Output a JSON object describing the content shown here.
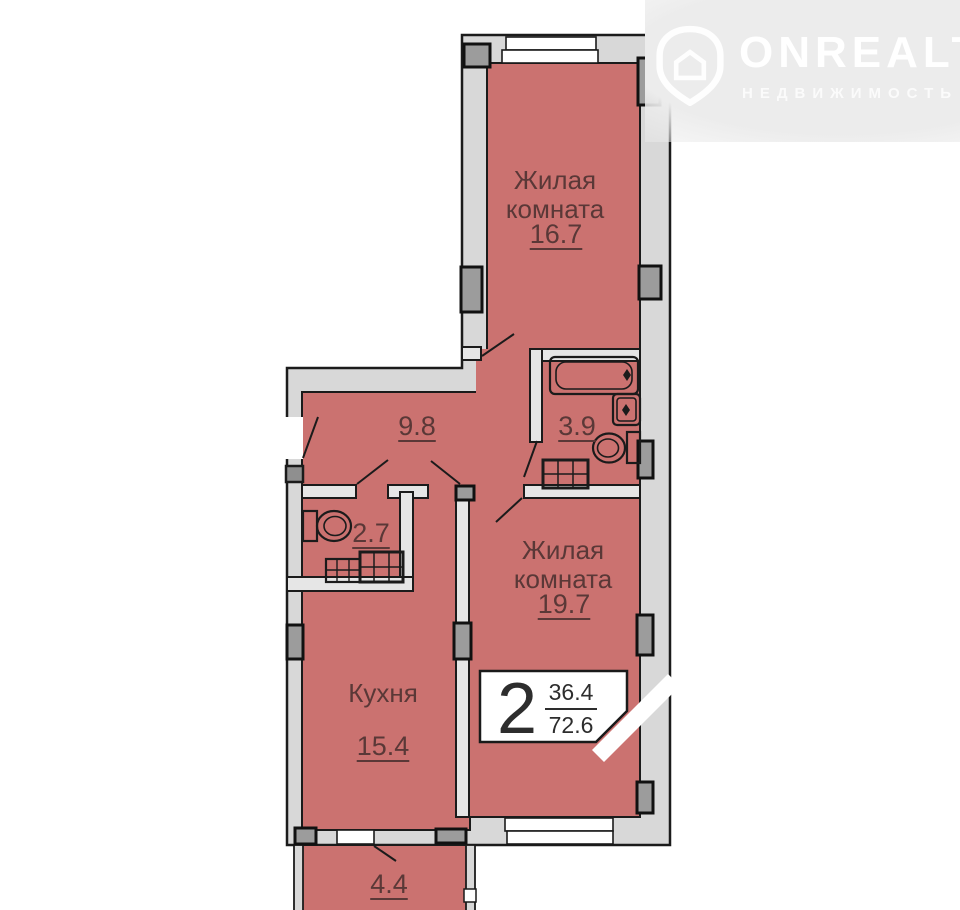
{
  "watermark": {
    "brand": "ONREALT",
    "subtitle": "НЕДВИЖИМОСТЬ"
  },
  "plan": {
    "rooms": {
      "living1": {
        "name": "Жилая комната",
        "area": "16.7"
      },
      "living2": {
        "name": "Жилая комната",
        "area": "19.7"
      },
      "kitchen": {
        "name": "Кухня",
        "area": "15.4"
      },
      "hallway": {
        "area": "9.8"
      },
      "bathroom": {
        "area": "3.9"
      },
      "wc": {
        "area": "2.7"
      },
      "balcony": {
        "area": "4.4"
      }
    },
    "badge": {
      "rooms_count": "2",
      "living_area": "36.4",
      "total_area": "72.6"
    }
  },
  "colors": {
    "room_fill": "#cb7270",
    "wall_fill": "#d8d8d8",
    "outline": "#1b1b1b",
    "label_text": "#5a3837"
  }
}
